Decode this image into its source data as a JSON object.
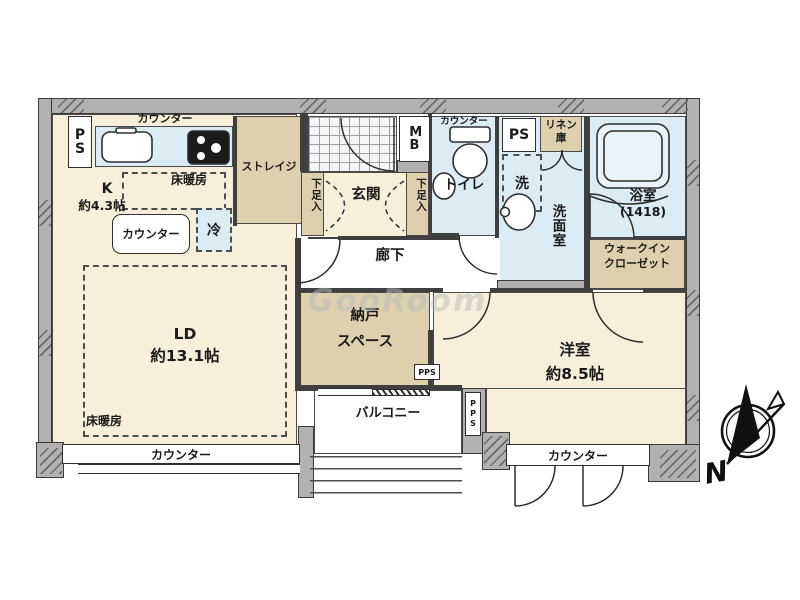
{
  "watermark": "GooRoom",
  "compass": {
    "north": "N"
  },
  "kitchen": {
    "counter_top": "カウンター",
    "ps": "PS",
    "name": "K",
    "size": "約4.3帖",
    "floor_heating": "床暖房",
    "island_counter": "カウンター",
    "fridge": "冷"
  },
  "storage": {
    "name": "ストレイジ"
  },
  "entrance": {
    "name": "玄関",
    "shoe_box_left": "下足入",
    "shoe_box_right": "下足入",
    "mb": "MB"
  },
  "toilet": {
    "name": "トイレ",
    "counter": "カウンター"
  },
  "washroom": {
    "name": "洗面室",
    "ps": "PS",
    "linen_line1": "リネン",
    "linen_line2": "庫",
    "washer": "洗"
  },
  "bathroom": {
    "name": "浴室",
    "size": "(1418)"
  },
  "hallway": {
    "name": "廊下"
  },
  "wic": {
    "line1": "ウォークイン",
    "line2": "クローゼット"
  },
  "living": {
    "name": "LD",
    "size": "約13.1帖",
    "floor_heating": "床暖房",
    "counter": "カウンター"
  },
  "storeroom": {
    "line1": "納戸",
    "line2": "スペース",
    "pps1": "PPS",
    "pps2": "PPS"
  },
  "bedroom": {
    "name": "洋室",
    "size": "約8.5帖",
    "counter": "カウンター"
  },
  "balcony": {
    "name": "バルコニー"
  }
}
